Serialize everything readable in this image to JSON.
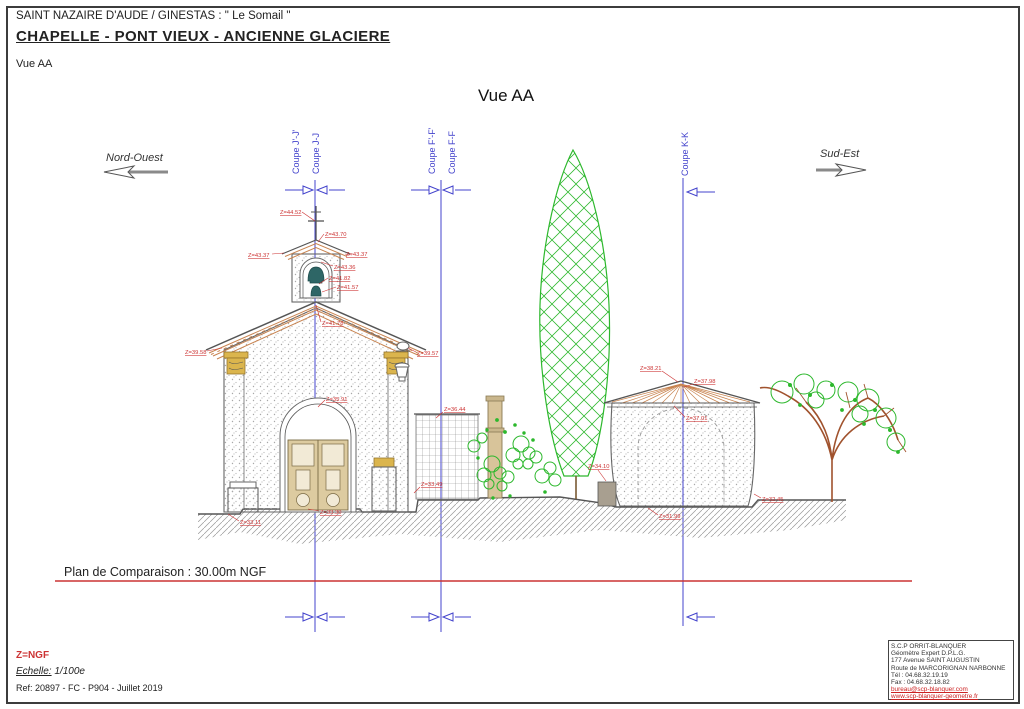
{
  "header": {
    "location": "SAINT NAZAIRE D'AUDE / GINESTAS : \" Le Somail \"",
    "title": "CHAPELLE - PONT VIEUX - ANCIENNE GLACIERE",
    "subtitle": "Vue AA"
  },
  "view": {
    "title": "Vue AA",
    "orientation_left": "Nord-Ouest",
    "orientation_right": "Sud-Est"
  },
  "sections": {
    "j_prime": "Coupe J'-J'",
    "j": "Coupe J-J",
    "f_prime": "Coupe F'-F'",
    "f": "Coupe F-F",
    "k": "Coupe K-K"
  },
  "elevations": {
    "cross_top": "Z=44.52",
    "belfry_ridge": "Z=43.70",
    "belfry_eave_left": "Z=43.37",
    "belfry_eave_right": "Z=43.37",
    "bell_arch": "Z=43.36",
    "belfry_base_1": "Z=41.82",
    "belfry_base_2": "Z=41.57",
    "roof_ridge": "Z=41.78",
    "eave_left": "Z=39.58",
    "lantern_right": "Z=39.57",
    "door_arch": "Z=35.91",
    "fence_top": "Z=36.44",
    "wall_base_center": "Z=33.49",
    "ground_left": "Z=33.11",
    "door_sill": "Z=33.30",
    "glaciere_roof_left": "Z=38.21",
    "glaciere_apex": "Z=37.98",
    "glaciere_eave": "Z=37.01",
    "block_left": "Z=34.10",
    "glaciere_base": "Z=31.99",
    "ground_right": "Z=32.45"
  },
  "datum": {
    "label": "Plan de Comparaison : 30.00m NGF"
  },
  "footer": {
    "datum_ref": "Z=NGF",
    "scale_label": "Echelle:",
    "scale_value": "1/100e",
    "reference": "Ref: 20897 - FC - P904 - Juillet 2019"
  },
  "stamp": {
    "line1": "S.C.P ORRIT-BLANQUER",
    "line2": "Géomètre Expert D.P.L.G.",
    "line3": "177 Avenue SAINT AUGUSTIN",
    "line4": "Route de MARCORIGNAN NARBONNE",
    "line5": "Tél : 04.68.32.19.19",
    "line6": "Fax : 04.68.32.18.82",
    "line7": "bureau@scp-blanquer.com",
    "line8": "www.scp-blanquer-geometre.fr"
  },
  "colors": {
    "section_blue": "#4343cc",
    "annotation_red": "#cc3333",
    "roof_orange": "#c8834f",
    "vegetation_green": "#2db82d",
    "gold": "#dbb54d"
  }
}
